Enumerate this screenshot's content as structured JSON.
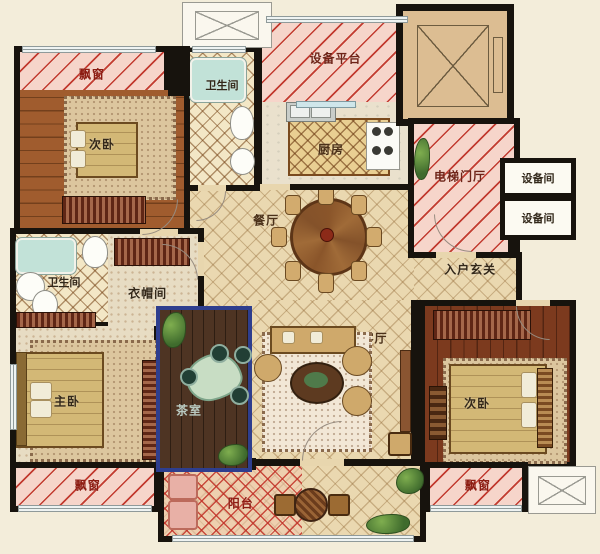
{
  "plan": {
    "type": "apartment-floor-plan",
    "rooms": {
      "bay_window_top_left": {
        "label": "飘窗"
      },
      "bedroom_top_left": {
        "label": "次卧"
      },
      "bathroom_top": {
        "label": "卫生间"
      },
      "equipment_platform": {
        "label": "设备平台"
      },
      "kitchen": {
        "label": "厨房"
      },
      "elevator_lobby": {
        "label": "电梯门厅"
      },
      "equipment_room_upper": {
        "label": "设备间"
      },
      "equipment_room_lower": {
        "label": "设备间"
      },
      "dining_room": {
        "label": "餐厅"
      },
      "entry_hall": {
        "label": "入户玄关"
      },
      "bathroom_left": {
        "label": "卫生间"
      },
      "cloakroom": {
        "label": "衣帽间"
      },
      "master_bedroom": {
        "label": "主卧"
      },
      "tea_room": {
        "label": "茶室"
      },
      "living_room": {
        "label": "客厅"
      },
      "bedroom_right": {
        "label": "次卧"
      },
      "bay_window_bottom_left": {
        "label": "飘窗"
      },
      "bay_window_bottom_right": {
        "label": "飘窗"
      },
      "balcony": {
        "label": "阳台"
      }
    },
    "colors": {
      "wall": "#17130d",
      "background": "#f3edda",
      "hatch_fill": "#f6d5ca",
      "hatch_line": "#c23b30",
      "tea_room_border": "#2e3e8e",
      "tile_floor": "#ead8b0",
      "dark_wood_floor": "#7c3a1e",
      "label_red": "#8c1c12"
    }
  }
}
